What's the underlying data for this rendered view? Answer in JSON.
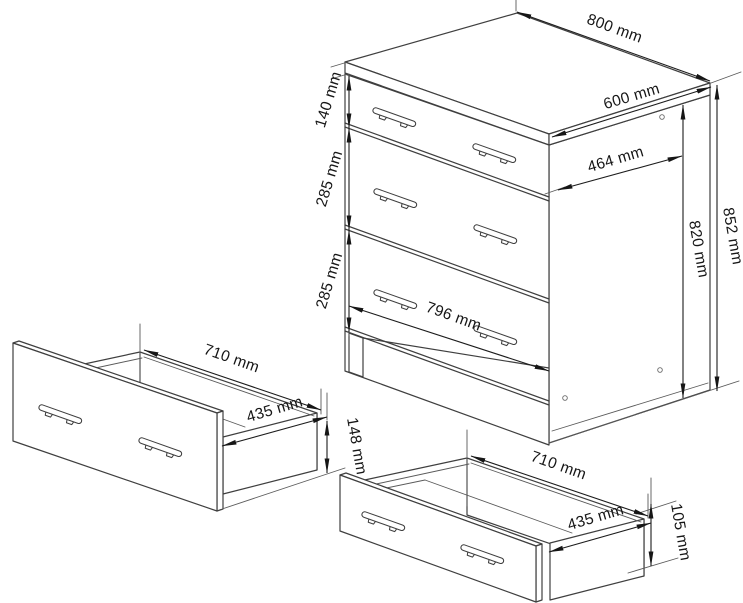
{
  "drawing": {
    "type": "furniture-dimension-diagram",
    "views": {
      "cabinet": "three-drawer base cabinet isometric view",
      "large_drawer": "single drawer box detail (tall front)",
      "small_drawer": "single drawer box detail (short front)"
    }
  },
  "dimensions": {
    "cabinet": {
      "top_width": "800 mm",
      "top_depth": "600 mm",
      "body_depth": "464 mm",
      "total_height": "852 mm",
      "body_height": "820 mm",
      "top_drawer_height": "140 mm",
      "middle_drawer_height": "285 mm",
      "bottom_drawer_height": "285 mm",
      "drawer_front_width": "796 mm"
    },
    "large_drawer": {
      "width": "710 mm",
      "depth": "435 mm",
      "front_height": "148 mm"
    },
    "small_drawer": {
      "width": "710 mm",
      "depth": "435 mm",
      "front_height": "105 mm"
    }
  },
  "colors": {
    "background": "#ffffff",
    "object_line": "#3f3f3f",
    "dimension_line": "#1c1c1c",
    "text": "#161616"
  }
}
